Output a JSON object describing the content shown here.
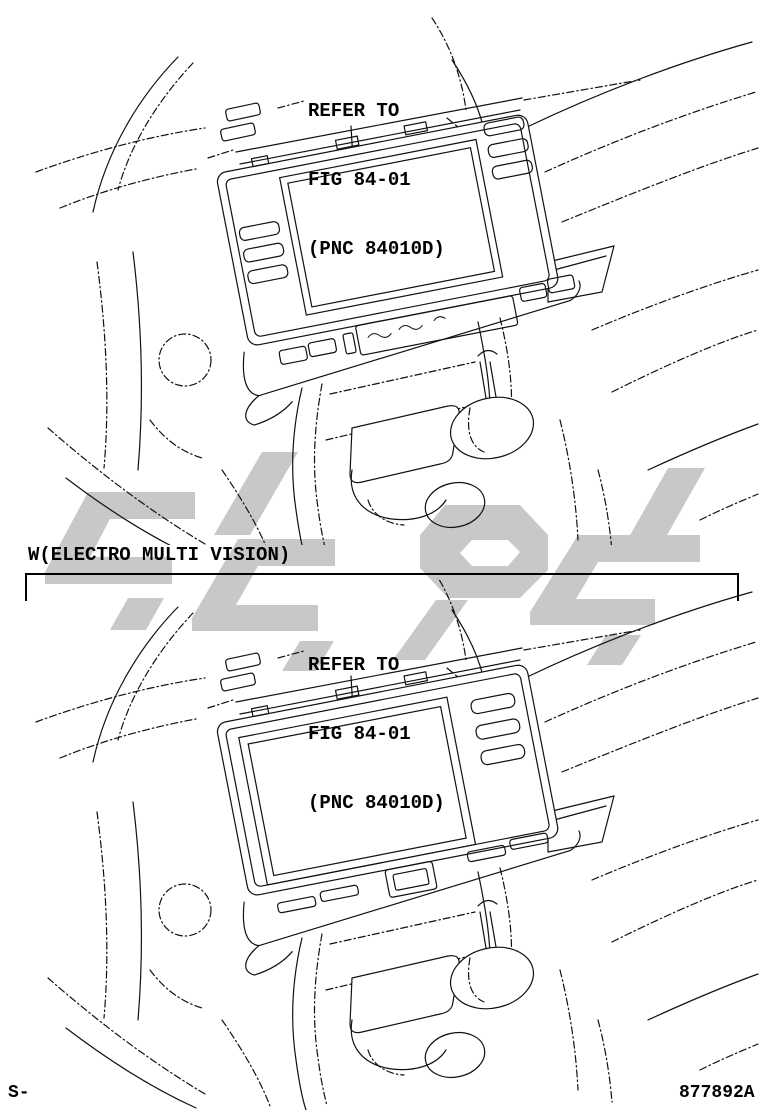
{
  "panels": [
    {
      "callout": {
        "line1": "REFER TO",
        "line2": "FIG 84-01",
        "line3": "(PNC 84010D)"
      }
    },
    {
      "callout": {
        "line1": "REFER TO",
        "line2": "FIG 84-01",
        "line3": "(PNC 84010D)"
      }
    }
  ],
  "divider": {
    "label": "W(ELECTRO MULTI VISION)"
  },
  "footer": {
    "left_code": "S-",
    "right_code": "877892A"
  },
  "colors": {
    "line": "#111111",
    "watermark": "#c8c8c8",
    "background": "#ffffff"
  }
}
